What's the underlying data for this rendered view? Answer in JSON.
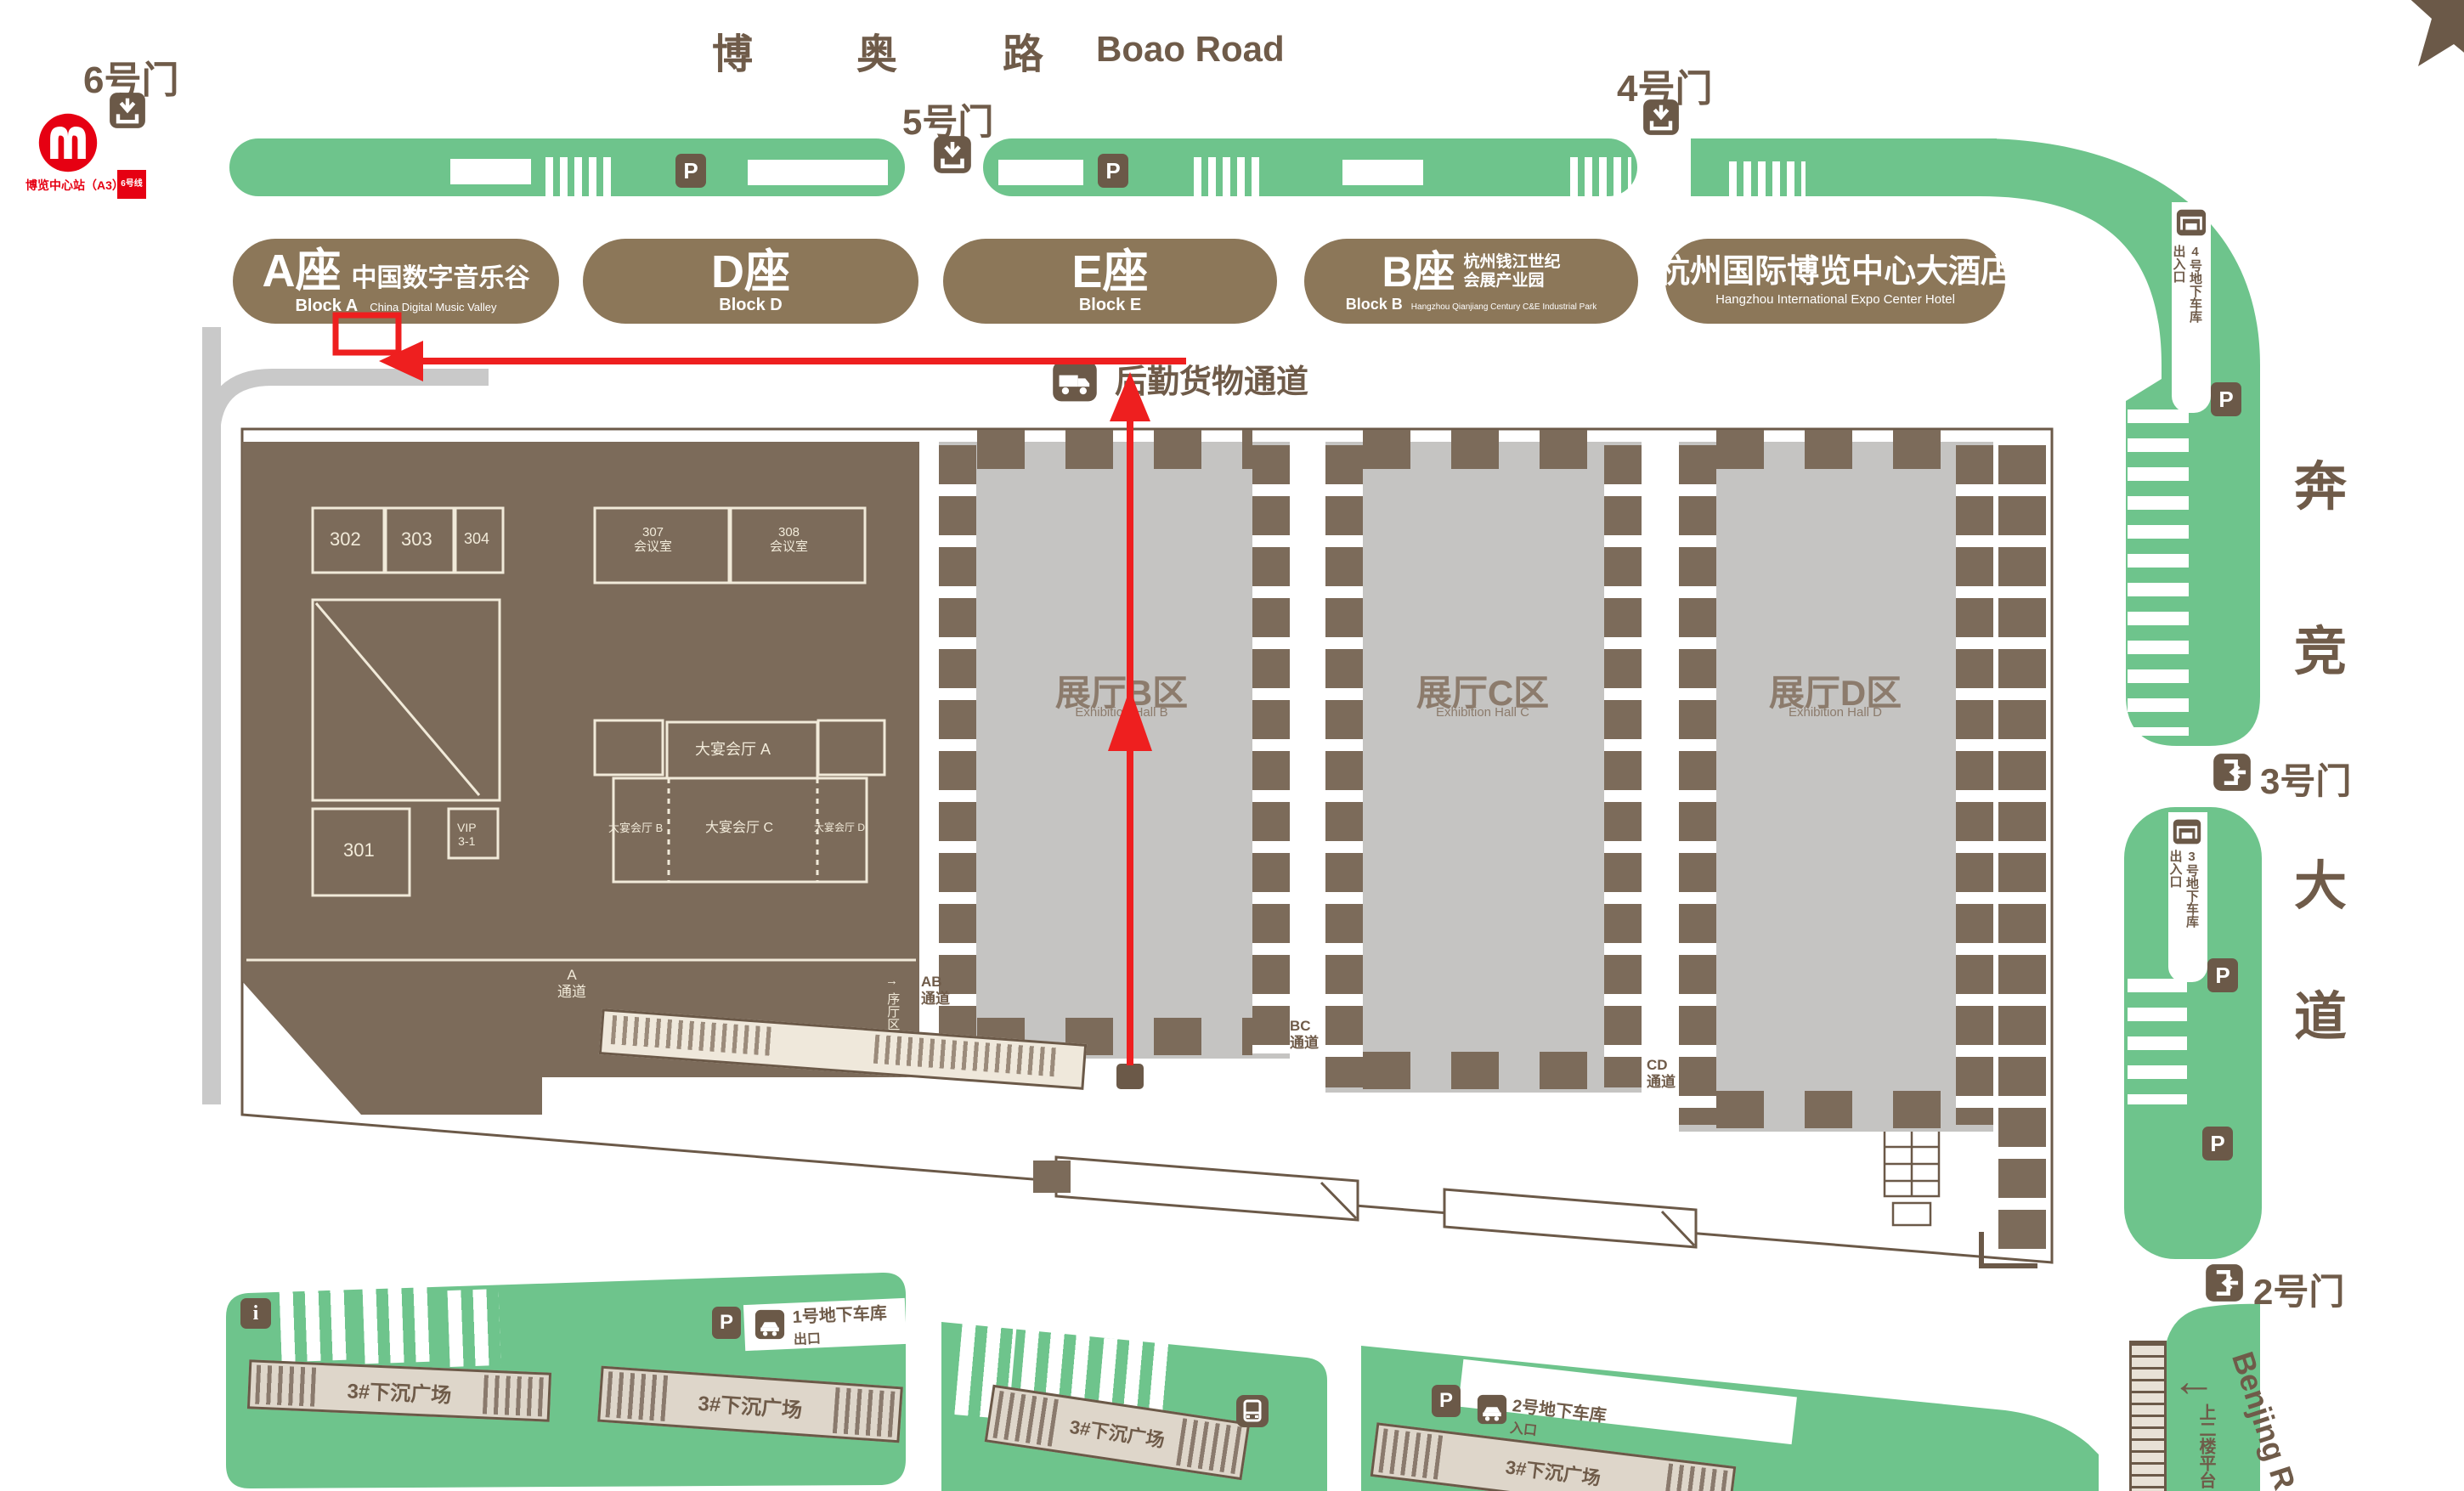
{
  "metro": {
    "station": "博览中心站（A3）",
    "line_badge": "6号线"
  },
  "top_road": {
    "cn": [
      "博",
      "奥",
      "路"
    ],
    "en": "Boao Road"
  },
  "gates": {
    "g6": "6号门",
    "g5": "5号门",
    "g4": "4号门",
    "g3": "3号门",
    "g2": "2号门"
  },
  "blocks": {
    "a": {
      "cn": "A座",
      "sub_cn": "中国数字音乐谷",
      "en": "Block A",
      "sub_en": "China Digital Music Valley"
    },
    "d": {
      "cn": "D座",
      "en": "Block D"
    },
    "e": {
      "cn": "E座",
      "en": "Block E"
    },
    "b": {
      "cn": "B座",
      "sub_cn1": "杭州钱江世纪",
      "sub_cn2": "会展产业园",
      "en": "Block B",
      "sub_en": "Hangzhou Qianjiang Century C&E Industrial Park"
    },
    "hotel": {
      "cn": "杭州国际博览中心大酒店",
      "en": "Hangzhou International Expo Center Hotel"
    }
  },
  "annotation": {
    "logistics": "后勤货物通道"
  },
  "halls": {
    "b": {
      "cn": "展厅B区",
      "en": "Exhibition Hall B"
    },
    "c": {
      "cn": "展厅C区",
      "en": "Exhibition Hall C"
    },
    "d": {
      "cn": "展厅D区",
      "en": "Exhibition Hall D"
    }
  },
  "rooms": {
    "r302": "302",
    "r303": "303",
    "r304": "304",
    "r301": "301",
    "vip_l1": "VIP",
    "vip_l2": "3-1",
    "r307_l1": "307",
    "r307_l2": "会议室",
    "r308_l1": "308",
    "r308_l2": "会议室",
    "bq_a": "大宴会厅 A",
    "bq_b": "大宴会厅 B",
    "bq_c": "大宴会厅 C",
    "bq_d": "大宴会厅 D"
  },
  "passages": {
    "a_l1": "A",
    "a_l2": "通道",
    "ab_l1": "AB",
    "ab_l2": "通道",
    "bc_l1": "BC",
    "bc_l2": "通道",
    "cd_l1": "CD",
    "cd_l2": "通道",
    "foyer": "序厅区",
    "foyer_arrow": "→"
  },
  "garages": {
    "g4_main": "4号地下车库",
    "g4_sub": "出入口",
    "g3_main": "3号地下车库",
    "g3_sub": "出入口",
    "g1_l1": "1号地下车库",
    "g1_l2": "出口",
    "g2_l1": "2号地下车库",
    "g2_l2": "入口"
  },
  "right_road": {
    "cn": [
      "奔",
      "竞",
      "大",
      "道"
    ],
    "en": "Benjing R",
    "platform": "上二楼平台",
    "arrow": "←"
  },
  "plazas": {
    "p1": "3#下沉广场",
    "p2": "3#下沉广场",
    "p3": "3#下沉广场",
    "p4": "3#下沉广场"
  },
  "icons": {
    "parking": "P",
    "info": "i"
  },
  "colors": {
    "road_green": "#6ec48c",
    "plan_brown": "#7c6b5a",
    "hall_gray": "#c5c4c2",
    "label_brown": "#6f5b49",
    "icon_brown": "#6b5948",
    "accent_red": "#ee1f1f",
    "metro_red": "#e60012"
  }
}
